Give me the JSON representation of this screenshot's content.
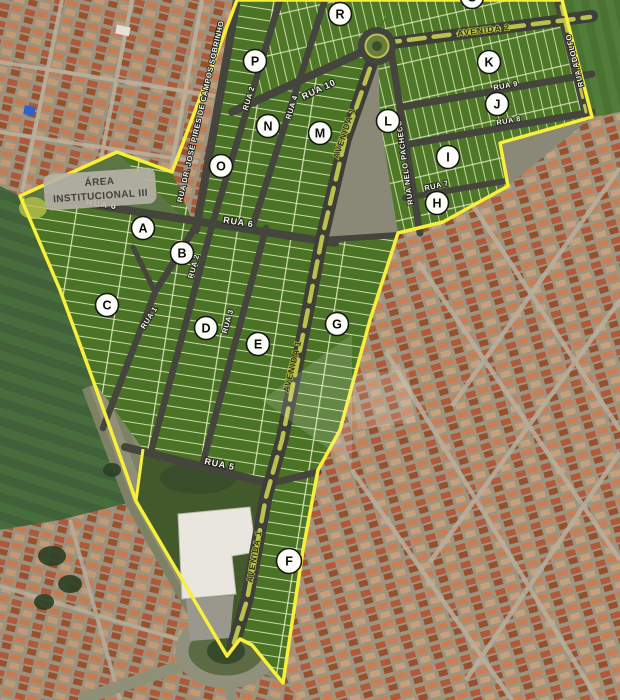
{
  "plan": {
    "institutional_area": {
      "line1": "ÁREA",
      "line2": "INSTITUCIONAL III"
    },
    "blocks": {
      "a": "A",
      "b": "B",
      "c": "C",
      "d": "D",
      "e": "E",
      "f": "F",
      "g": "G",
      "h": "H",
      "i": "I",
      "j": "J",
      "k": "K",
      "l": "L",
      "m": "M",
      "n": "N",
      "o": "O",
      "p": "P",
      "r": "R",
      "s": "S"
    },
    "streets": {
      "rua1": "RUA 1",
      "rua2": "RUA 2",
      "rua3": "RUA 3",
      "rua4": "RUA 4",
      "rua5": "RUA 5",
      "rua6": "RUA 6",
      "rua7": "RUA 7",
      "rua8": "RUA 8",
      "rua9": "RUA 9",
      "rua10": "RUA 10",
      "avenida1": "AVENIDA 1",
      "avenida2": "AVENIDA 2",
      "rua_adolfo": "RUA ADOLFO",
      "rua_nelo_pacheco": "RUA NELO PACHECO",
      "rua_jose_pires": "RUA DR. JOSÉ PIRES DE CAMPOS SOBRINHO"
    },
    "colors": {
      "boundary_yellow": "#f7ef3c",
      "street_gray": "#45453e",
      "lot_green": "#4a7326",
      "median_green": "#b9c24e"
    }
  }
}
